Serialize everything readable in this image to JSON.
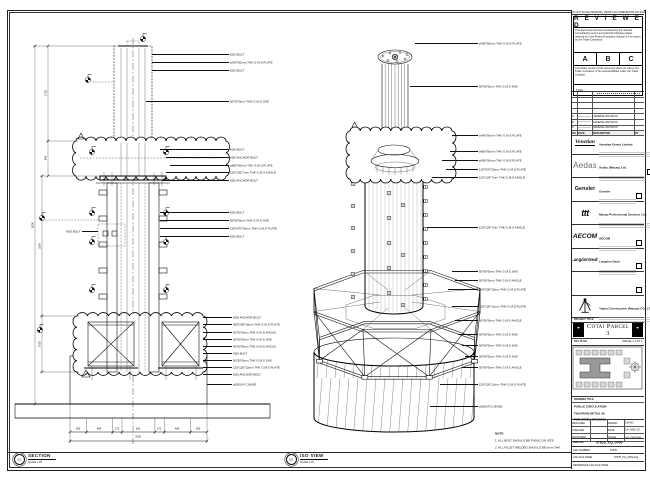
{
  "views": {
    "section": {
      "no": "01",
      "title": "SECTION",
      "scale": "SCALE 1:25",
      "callouts": [
        "M20 BOLT",
        "ø345*50mm THK G.M.S PLATE",
        "M20 BOLT",
        "50*50*5mm THK G.M.S SHS",
        "M20 BOLT",
        "M20 ANCHOR BOLT",
        "ø800*50mm THK G.M.S PLATE",
        "120*120*7mm THK G.M.S ANGLE",
        "M20 ANCHOR BOLT",
        "M20 BOLT",
        "50*50*5mm THK G.M.S SHS",
        "120*670*25mm THK G.M.S PLATE",
        "M20 BOLT",
        "M20 BOLT",
        "M20 ANCHOR BOLT",
        "400*200*16mm THK G.M.S PLATE",
        "50*50*5mm THK G.M.S ANGLE",
        "50*50*5mm THK G.M.S SHS",
        "50*50*5mm THK G.M.S ANGLE",
        "M20 BOLT",
        "50*50*5mm THK G.M.S SHS",
        "120*120*12mm THK G.M.S PLATE",
        "M20 ANCHOR BOLT",
        "ø2500 R.C BASE"
      ],
      "dims": {
        "bottom_segments": [
          "300",
          "480",
          "170",
          "600",
          "170",
          "480",
          "300"
        ],
        "bottom_total": "2500",
        "left": [
          "1730",
          "640",
          "2550",
          "1020",
          "6530"
        ]
      }
    },
    "iso": {
      "no": "02",
      "title": "ISO VIEW",
      "scale": "SCALE 1:25",
      "callouts": [
        "ø345*50mm THK G.M.S PLATE",
        "50*50*5mm THK G.M.S SHS",
        "ø345*50mm THK G.M.S PLATE",
        "ø800*50mm THK G.M.S PLATE",
        "ø345*50mm THK G.M.S PLATE",
        "120*670*25mm THK G.M.S PLATE",
        "120*120*7mm THK G.M.S ANGLE",
        "120*120*7mm THK G.M.S ANGLE",
        "50*50*5mm THK G.M.S SHS",
        "50*50*5mm THK G.M.S ANGLE",
        "400*200*16mm THK G.M.S PLATE",
        "120*120*12mm THK G.M.S PLATE",
        "50*50*5mm THK G.M.S ANGLE",
        "50*50*5mm THK G.M.S SHS",
        "50*50*5mm THK G.M.S SHS",
        "50*50*5mm THK G.M.S SHS",
        "50*50*5mm THK G.M.S ANGLE",
        "120*120*12mm THK G.M.S PLATE",
        "ø2500 R.C BASE"
      ],
      "note": {
        "title": "NOTE:",
        "line1": "1. ALL BOLT SHOULD BE FIXING ON SITE.",
        "line2": "2. ALL FILLET WELDED SHOULD BE 6mm THK."
      }
    }
  },
  "title_block": {
    "top_note": "DO NOT SCALE DRAWING. VERIFY ALL DIMENSIONS ON SITE.",
    "reviewed": {
      "title": "R E V I E W E D",
      "para1": "This document has been reviewed by the relevant Consultant(s) and is accorded the following status referred to in the Project Procedure Section 5.4 for action by the Trade Contractor.",
      "status_a": "A",
      "status_b": "B",
      "status_c": "C",
      "para2": "Consultant review of this document does not relieve the Trade Contractor of his responsibilities under the Trade Contract.",
      "date_label": "Date :"
    },
    "revisions": {
      "header": [
        "NO.",
        "DATE",
        "DESCRIPTION",
        "BY"
      ],
      "rows": [
        {
          "rev": "C",
          "desc": "GENERAL REVISION"
        },
        {
          "rev": "B",
          "desc": "GENERAL REVISION"
        },
        {
          "rev": "A",
          "desc": "GENERAL REVISION"
        }
      ]
    },
    "consultants": [
      {
        "logo": "Venetian",
        "name": "Venetian Orient Limited"
      },
      {
        "logo": "Aedas",
        "name": "Aedas (Macau) Ltd."
      },
      {
        "logo": "Gensler",
        "name": "Gensler"
      },
      {
        "logo": "ttt",
        "name": "Macau Professional Services Ltd."
      },
      {
        "logo": "AECOM",
        "name": "AECOM"
      },
      {
        "logo": "LangdonSeah",
        "name": "Langdon Seah"
      },
      {
        "logo": "",
        "name": ""
      }
    ],
    "contractor": {
      "name": "Yadea Construction (Macau) CO., LTD."
    },
    "project": {
      "label": "PROJECT TITLE",
      "name": "Cotai Parcel 3"
    },
    "key_plan": {
      "label": "KEY PLAN",
      "sub": "PARCEL 3, LOT 2"
    },
    "drawing": {
      "title_label": "DRAWING TITLE",
      "title_line1": "PUBLIC CIRCULATION",
      "title_line2": "FOUNTAIN DETAIL IN",
      "title_line3": "FOR STEEL DRAWING",
      "designed_label": "DESIGNED",
      "designed": "-",
      "drawn_label": "DRAWN",
      "drawn": "CHAD",
      "checked_label": "CHECKED",
      "checked": "-",
      "date_label": "DATE",
      "date": "14-JUN-13",
      "approved_label": "APPROVED",
      "approved": "-",
      "scale_label": "SCALE",
      "scale": "AS SHOWN",
      "dwg_label": "DWG NO",
      "dwg_no": "57635_PQ_0009",
      "rev_label": "REV",
      "rev": "C",
      "cad_number_label": "CAD NUMBER",
      "cad_number": "57635",
      "cad_file_label": "CAD FILE NAME",
      "cad_file": "57635_PQ_0009.dwg",
      "ref_label": "REFERENCE CAD FILE NAME",
      "ref_value": ""
    }
  }
}
